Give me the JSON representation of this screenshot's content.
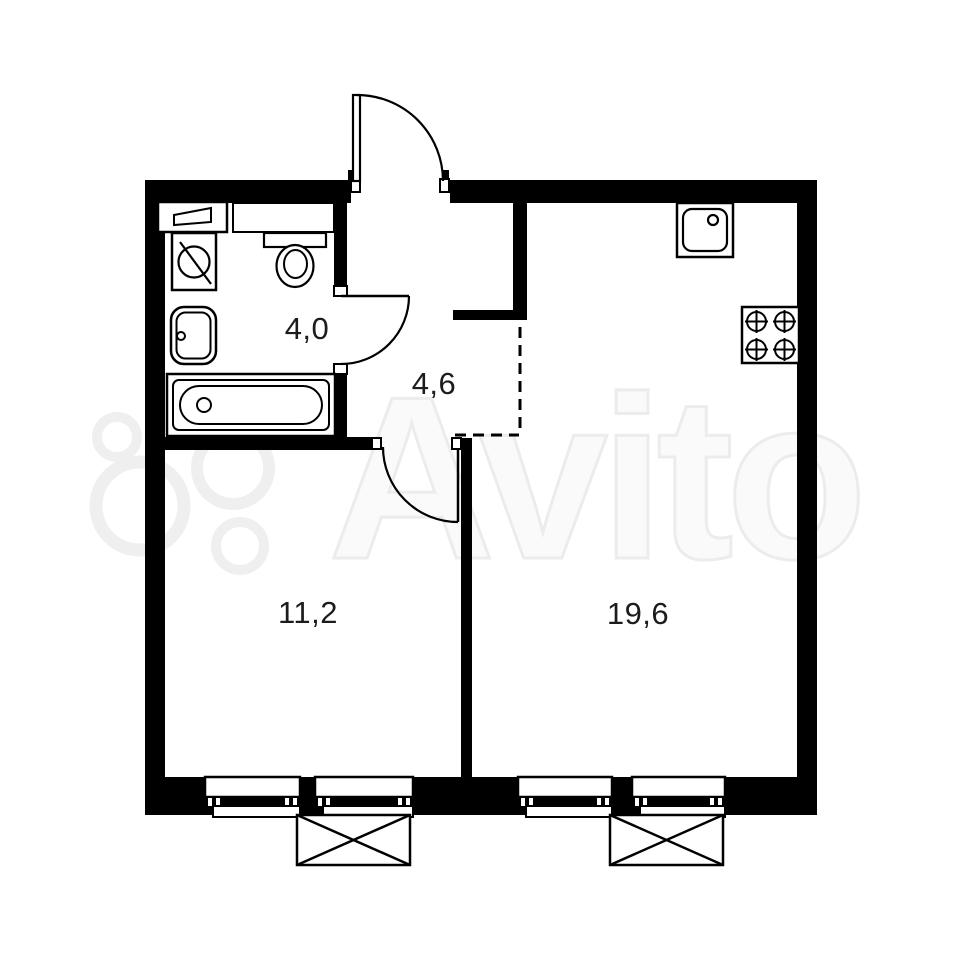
{
  "watermark": {
    "text": "Avito"
  },
  "rooms": [
    {
      "id": "bathroom",
      "area": "4,0"
    },
    {
      "id": "hallway",
      "area": "4,6"
    },
    {
      "id": "room",
      "area": "11,2"
    },
    {
      "id": "kitchen_living",
      "area": "19,6"
    }
  ],
  "fixtures": {
    "bathroom": [
      "shelf",
      "washing-machine",
      "sink",
      "bathtub",
      "toilet"
    ],
    "kitchen": [
      "sink",
      "stove-4-burners"
    ],
    "exterior": [
      "window",
      "window",
      "window",
      "window",
      "ac-unit-box",
      "ac-unit-box"
    ]
  },
  "colors": {
    "walls": "#000000",
    "background": "#ffffff",
    "label_text": "#1c1c1c",
    "watermark_ring": "#efefef",
    "watermark_text_fill": "#fafafa",
    "watermark_text_stroke": "#ececec"
  }
}
